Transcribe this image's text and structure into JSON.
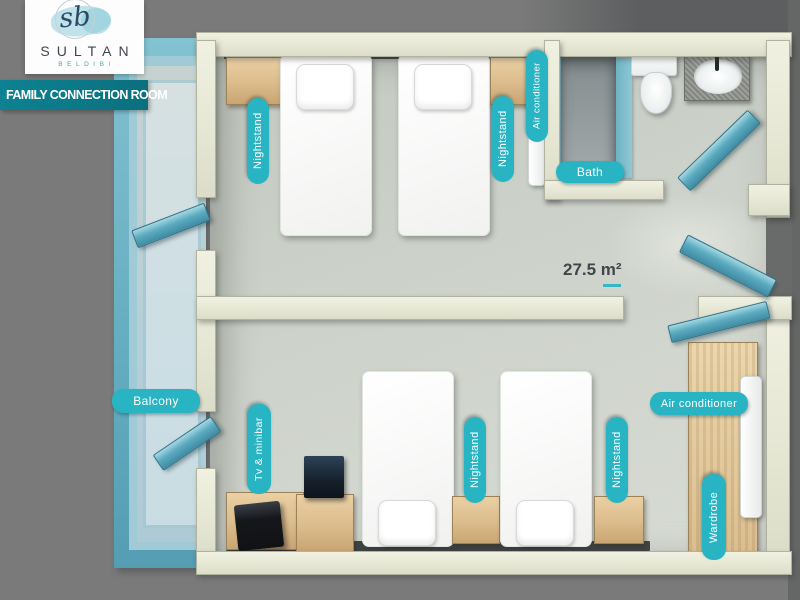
{
  "brand": {
    "monogram": "sb",
    "name": "SULTAN",
    "subname": "BELDIBI"
  },
  "banner": {
    "title": "FAMILY CONNECTION ROOM"
  },
  "plan": {
    "area": "27.5 m²"
  },
  "labels": {
    "balcony": "Balcony",
    "bath": "Bath",
    "nightstand": "Nightstand",
    "air_conditioner": "Air conditioner",
    "tv_minibar": "Tv & minibar",
    "wardrobe": "Wardrobe"
  },
  "colors": {
    "accent_teal": "#28b4c3",
    "banner_teal": "#0d8090",
    "wall_cream": "#e8e9d7",
    "floor": "#cdd2ca",
    "door_teal": "#57a8bd",
    "wood": "#dcbe90",
    "balcony_rail": "#6fb6c9",
    "background": "#7a7a7a"
  }
}
